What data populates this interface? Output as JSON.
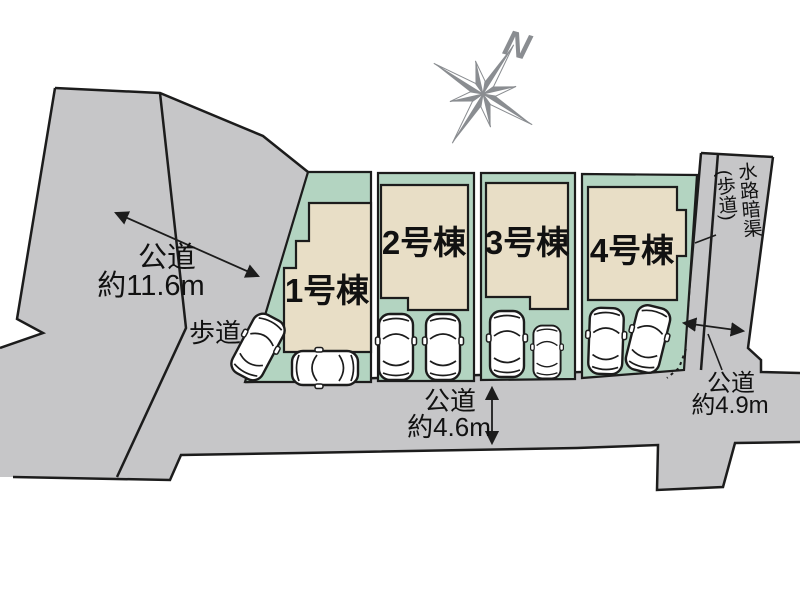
{
  "compass": {
    "label": "N"
  },
  "buildings": [
    {
      "label": "1号棟"
    },
    {
      "label": "2号棟"
    },
    {
      "label": "3号棟"
    },
    {
      "label": "4号棟"
    }
  ],
  "roads": {
    "left": {
      "label": "公道",
      "width": "約11.6m"
    },
    "bottom": {
      "label": "公道",
      "width": "約4.6m"
    },
    "right": {
      "label": "公道",
      "width": "約4.9m"
    }
  },
  "sidewalk": {
    "label": "歩道"
  },
  "waterway": {
    "label": "水路暗渠",
    "sub": "(歩道)"
  },
  "colors": {
    "road": "#c6c6c8",
    "lot_green": "#b3d4c1",
    "building_beige": "#e8dec6",
    "outline": "#1c1c1c",
    "compass_gray": "#8a8d91"
  }
}
